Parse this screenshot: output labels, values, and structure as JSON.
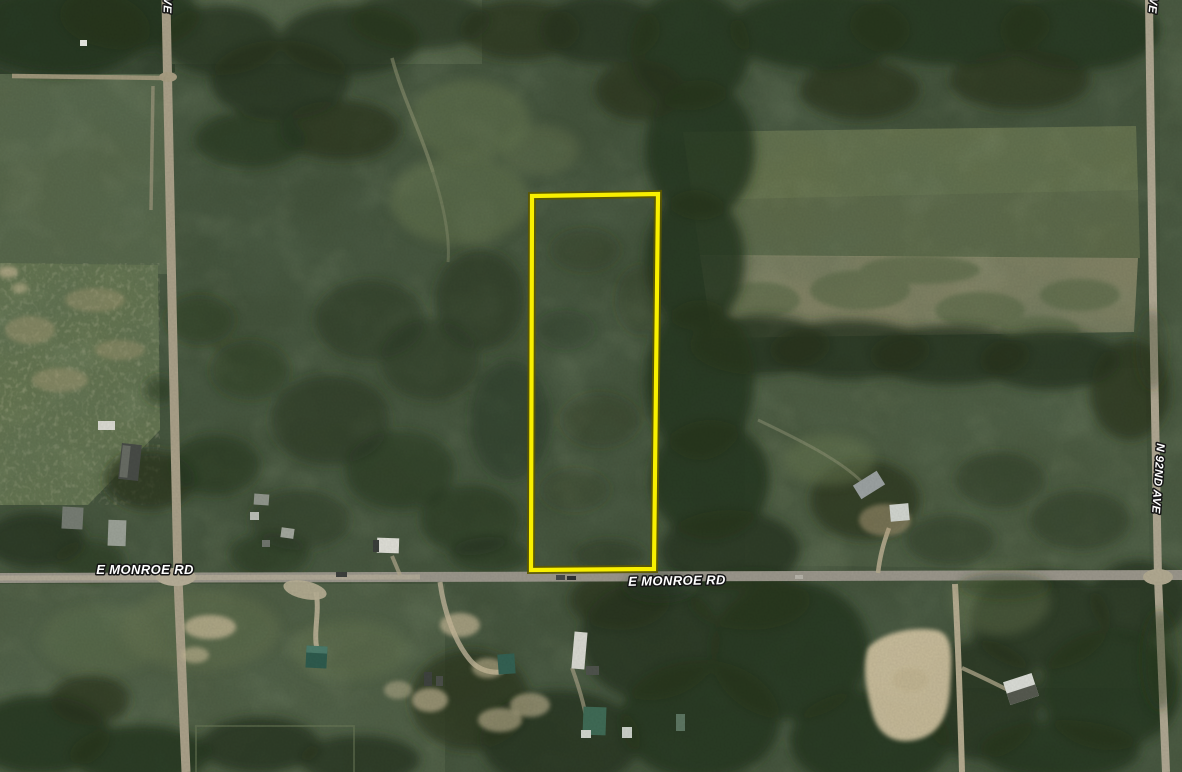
{
  "map": {
    "view_type": "aerial-satellite-parcel-view",
    "labels": {
      "monroe_left": "E MONROE RD",
      "monroe_right": "E MONROE RD",
      "n_92nd_ave": "N 92ND AVE",
      "top_left_partial": "VE",
      "top_right_partial": "VE"
    },
    "parcel": {
      "outline_color": "#f8ef00",
      "outline_halo": "#5b5700"
    },
    "colors": {
      "label_text": "#ffffff",
      "label_halo": "#161616",
      "base_green": "#43523b",
      "forest_green": "#27351f",
      "road_tan": "#a89f88",
      "road_gray": "#99958a",
      "sand": "#cfc1a0"
    }
  }
}
